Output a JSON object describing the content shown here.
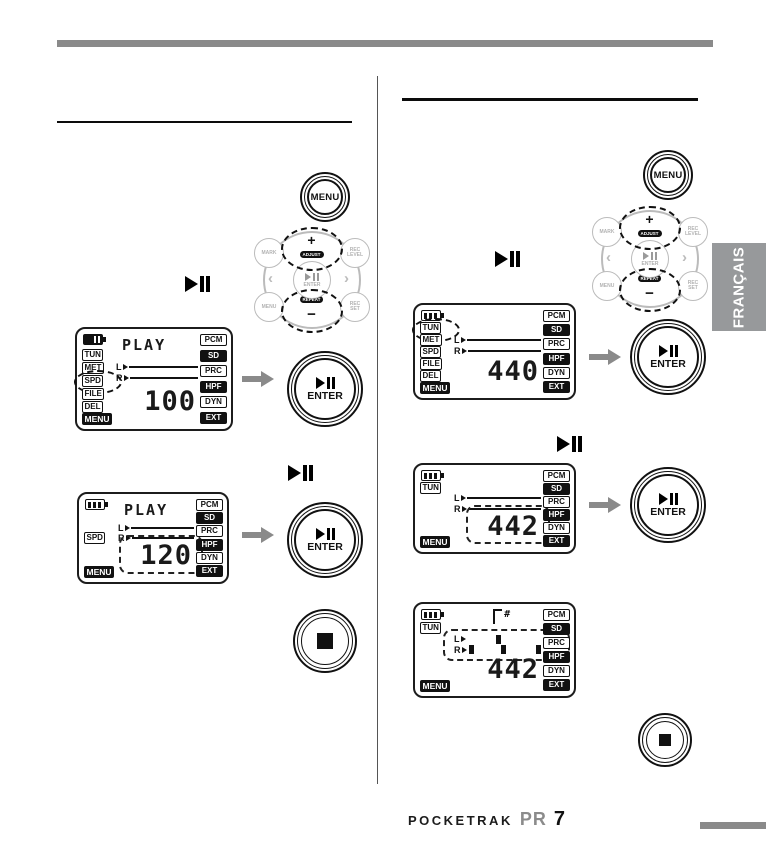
{
  "page": {
    "language_tab": "FRANÇAIS",
    "brand": "POCKETRAK",
    "model_outline": "PR",
    "model_digit": "7"
  },
  "labels": {
    "menu": "MENU",
    "enter": "ENTER"
  },
  "buttons": {
    "dpad": {
      "plus": "+",
      "plus_sub": "ADJUST",
      "minus": "−",
      "minus_sub": "REPEAT",
      "left": "‹",
      "right": "›",
      "corners": [
        "MARK",
        "REC LEVEL",
        "MENU",
        "REC SET"
      ],
      "center_label": "ENTER"
    }
  },
  "lcd_right_icons": [
    {
      "label": "PCM",
      "filled": false
    },
    {
      "label": "SD",
      "filled": true
    },
    {
      "label": "PRC",
      "filled": false
    },
    {
      "label": "HPF",
      "filled": true
    },
    {
      "label": "DYN",
      "filled": false
    },
    {
      "label": "EXT",
      "filled": true
    }
  ],
  "screens": [
    {
      "name": "play-speed-100",
      "battery": "dark",
      "slots": [
        {
          "label": "TUN"
        },
        {
          "label": "MET"
        },
        {
          "label": "SPD",
          "highlight": true
        },
        {
          "label": "FILE"
        },
        {
          "label": "DEL"
        }
      ],
      "menu": {
        "label": "MENU"
      },
      "title": "PLAY",
      "l_label": "L",
      "r_label": "R",
      "lines": true,
      "value": "100",
      "value_highlighted": false
    },
    {
      "name": "play-speed-120",
      "battery": "bars",
      "slots": [
        null,
        null,
        {
          "label": "SPD"
        },
        null,
        null
      ],
      "menu": {
        "label": "MENU"
      },
      "title": "PLAY",
      "l_label": "L",
      "r_label": "R",
      "lines": true,
      "value": "120",
      "value_highlighted": true
    },
    {
      "name": "tuner-calibration-440",
      "battery": "bars",
      "slots": [
        {
          "label": "TUN",
          "highlight": true
        },
        {
          "label": "MET"
        },
        {
          "label": "SPD"
        },
        {
          "label": "FILE"
        },
        {
          "label": "DEL"
        }
      ],
      "menu": {
        "label": "MENU"
      },
      "title": "",
      "l_label": "L",
      "r_label": "R",
      "lines": true,
      "value": "440",
      "value_highlighted": false
    },
    {
      "name": "tuner-calibration-442",
      "battery": "bars",
      "slots": [
        {
          "label": "TUN"
        },
        null,
        null,
        null,
        null
      ],
      "menu": {
        "label": "MENU"
      },
      "title": "",
      "l_label": "L",
      "r_label": "R",
      "lines": true,
      "value": "442",
      "value_highlighted": true
    },
    {
      "name": "tuner-meter-442",
      "battery": "bars",
      "slots": [
        {
          "label": "TUN"
        },
        null,
        null,
        null,
        null
      ],
      "menu": {
        "label": "MENU"
      },
      "title": "",
      "note": "#",
      "l_label": "L",
      "r_label": "R",
      "lines": false,
      "meter": {
        "l_blocks": [
          0.4
        ],
        "r_blocks": [
          0.02,
          0.45,
          0.93
        ],
        "highlight": true
      },
      "value": "442",
      "value_highlighted": false
    }
  ]
}
